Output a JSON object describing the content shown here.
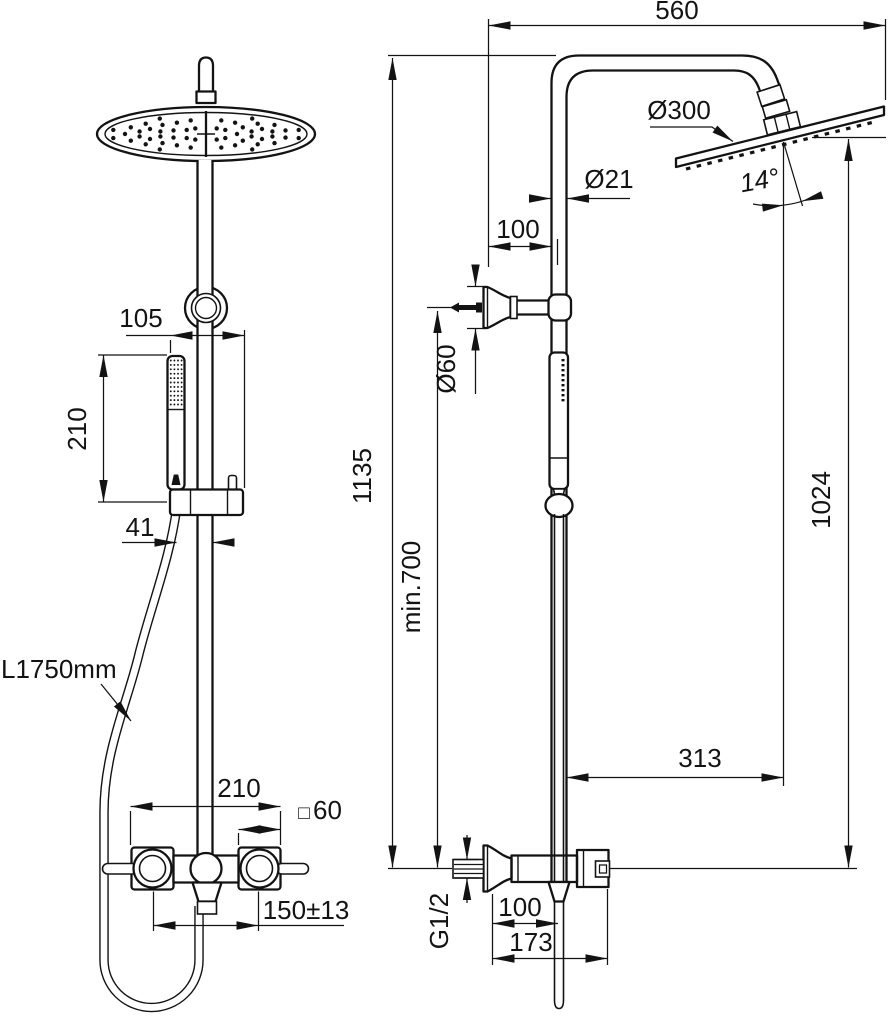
{
  "drawing": {
    "background": "#ffffff",
    "line_color": "#131313"
  },
  "front_view": {
    "handshower_offset": "105",
    "handshower_length": "210",
    "rail_offset": "41",
    "hose_length": "L1750mm",
    "valve_width": "210",
    "escutcheon_symbol": "□",
    "escutcheon_size": "60",
    "inlet_spacing": "150±13"
  },
  "side_view": {
    "arm_reach": "560",
    "head_diameter": "Ø300",
    "head_angle": "14°",
    "pipe_diameter": "Ø21",
    "wall_offset": "100",
    "bracket_diameter": "Ø60",
    "total_height": "1135",
    "min_height": "min.700",
    "head_height": "1024",
    "projection": "313",
    "thread_size": "G1/2",
    "inlet_depth": "100",
    "valve_depth": "173"
  }
}
